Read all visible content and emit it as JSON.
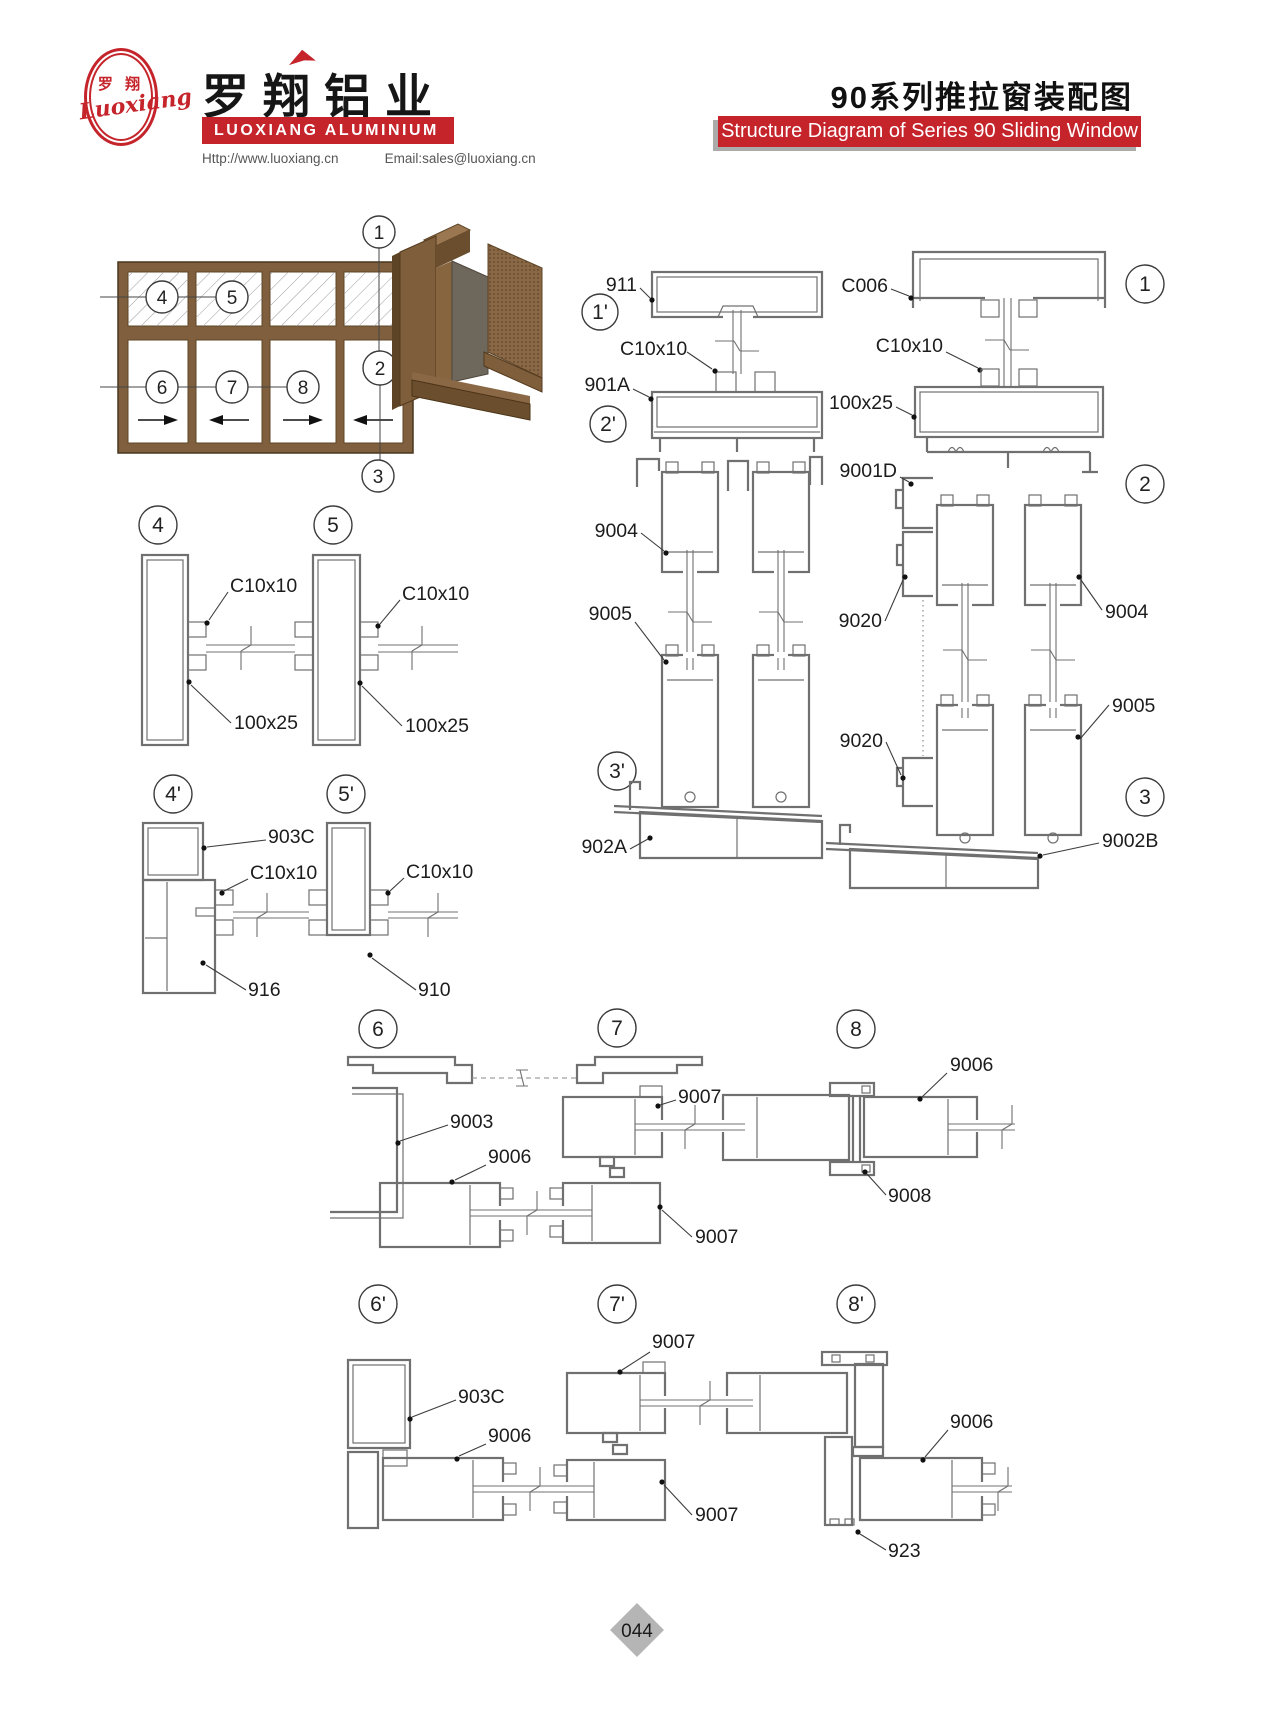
{
  "header": {
    "logo": {
      "cn": "罗 翔",
      "script": "Luoxiang"
    },
    "brand_cn": "罗翔铝业",
    "brand_en": "LUOXIANG ALUMINIUM",
    "contact": {
      "web": "Http://www.luoxiang.cn",
      "email": "Email:sales@luoxiang.cn"
    },
    "title_cn": "90系列推拉窗装配图",
    "title_en": "Structure Diagram of Series 90 Sliding Window"
  },
  "footer": {
    "page": "044"
  },
  "colors": {
    "accent_red": "#c5242b",
    "drawing_line": "#707070",
    "frame_brown": "#7f5f3d",
    "badge_gray": "#b5b5b5"
  },
  "callouts": {
    "n1": "1",
    "n2": "2",
    "n3": "3",
    "n4": "4",
    "n5": "5",
    "n6": "6",
    "n7": "7",
    "n8": "8",
    "n1p": "1'",
    "n2p": "2'",
    "n3p": "3'",
    "n4p": "4'",
    "n5p": "5'",
    "n6p": "6'",
    "n7p": "7'",
    "n8p": "8'"
  },
  "labels": {
    "p911": "911",
    "c10x10": "C10x10",
    "p901A": "901A",
    "p9004": "9004",
    "p9005": "9005",
    "p902A": "902A",
    "pC006": "C006",
    "s100x25": "100x25",
    "p9001D": "9001D",
    "p9020": "9020",
    "p9002B": "9002B",
    "p903C": "903C",
    "p916": "916",
    "p910": "910",
    "p9003": "9003",
    "p9006": "9006",
    "p9007": "9007",
    "p9008": "9008",
    "p923": "923"
  }
}
